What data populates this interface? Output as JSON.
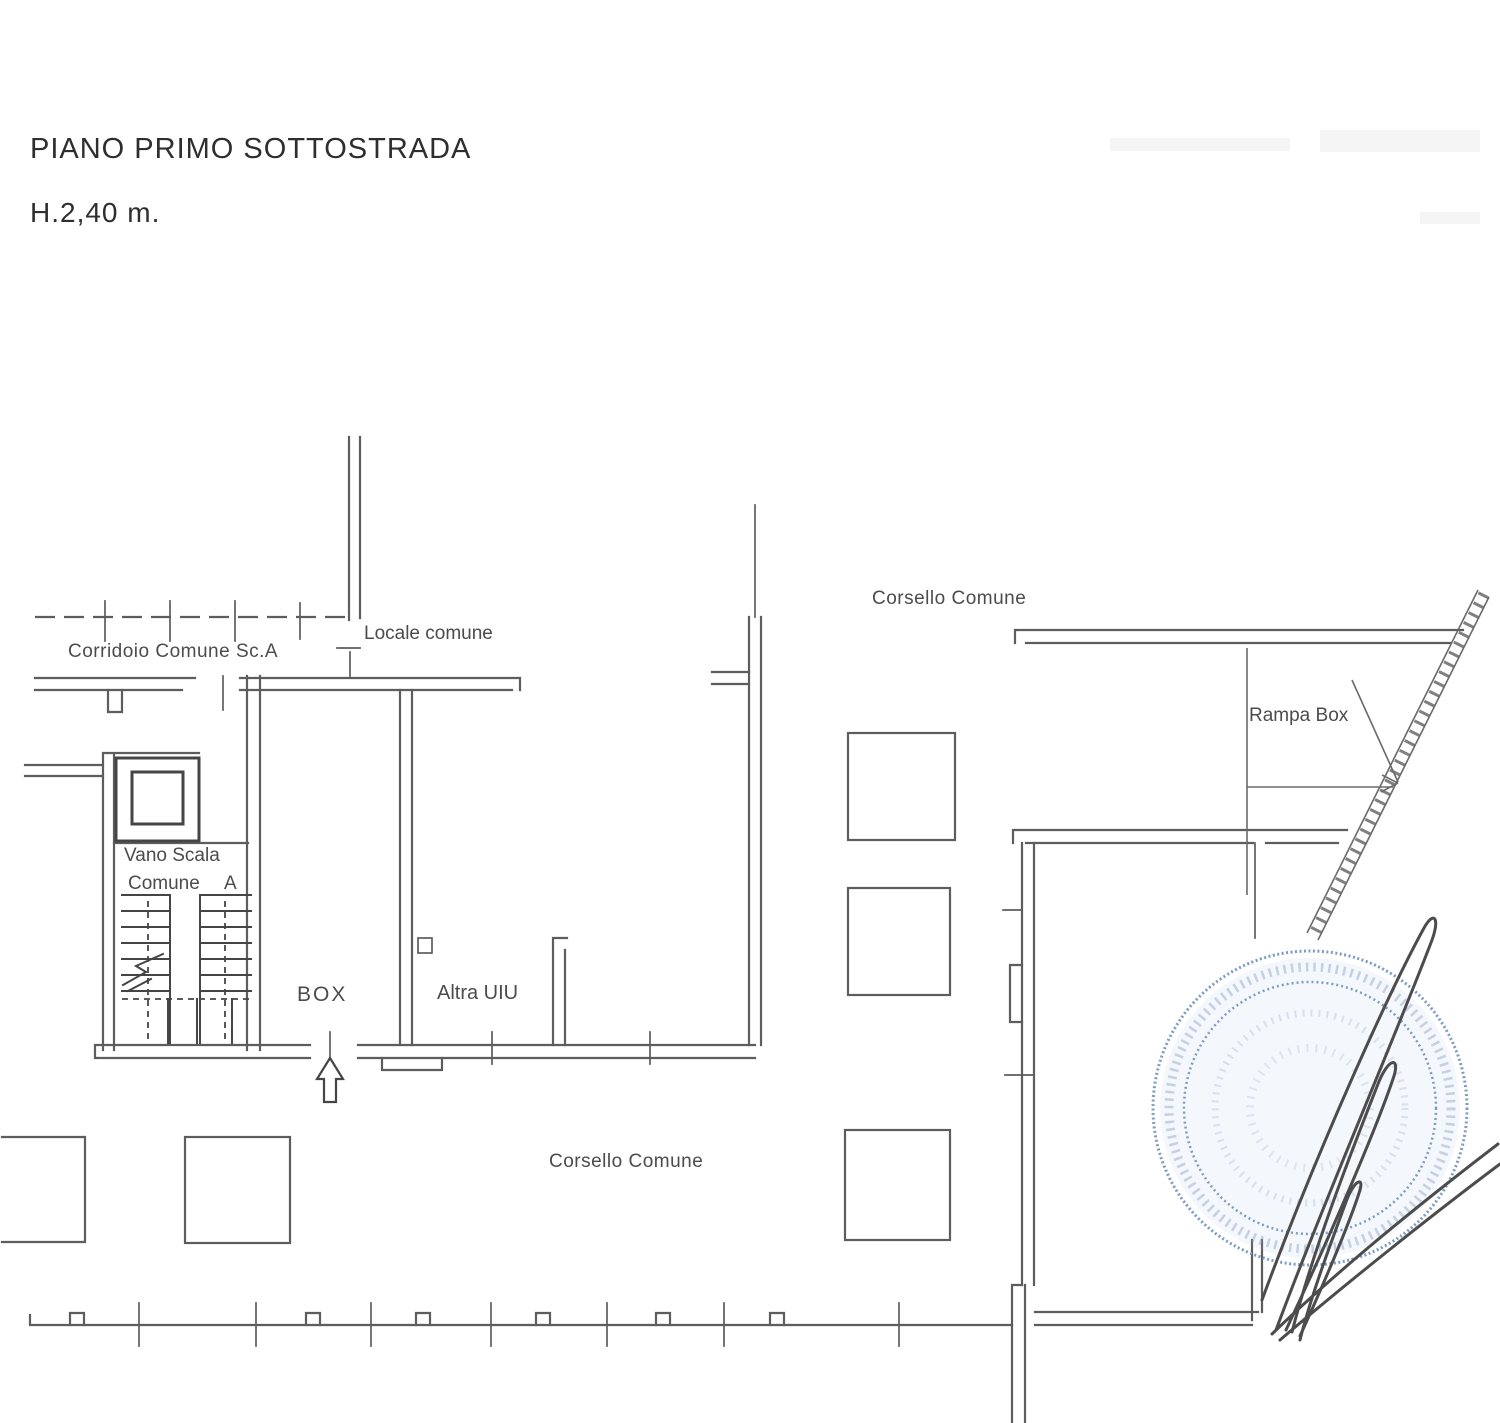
{
  "document": {
    "title": "PIANO PRIMO SOTTOSTRADA",
    "height_note": "H.2,40 m."
  },
  "plan": {
    "labels": {
      "corridoio": "Corridoio Comune Sc.A",
      "locale_comune": "Locale comune",
      "corsello_top": "Corsello Comune",
      "rampa_box": "Rampa Box",
      "vano_scala_line1": "Vano Scala",
      "vano_scala_line2": "Comune",
      "vano_scala_letter": "A",
      "box": "BOX",
      "altra_uiu": "Altra UIU",
      "corsello_bottom": "Corsello Comune"
    },
    "colors": {
      "line": "#5d5d5d",
      "dark": "#454545",
      "text": "#3c3c3c",
      "stamp_blue": "#7d9cc4",
      "signature": "#4c4c4c"
    }
  }
}
